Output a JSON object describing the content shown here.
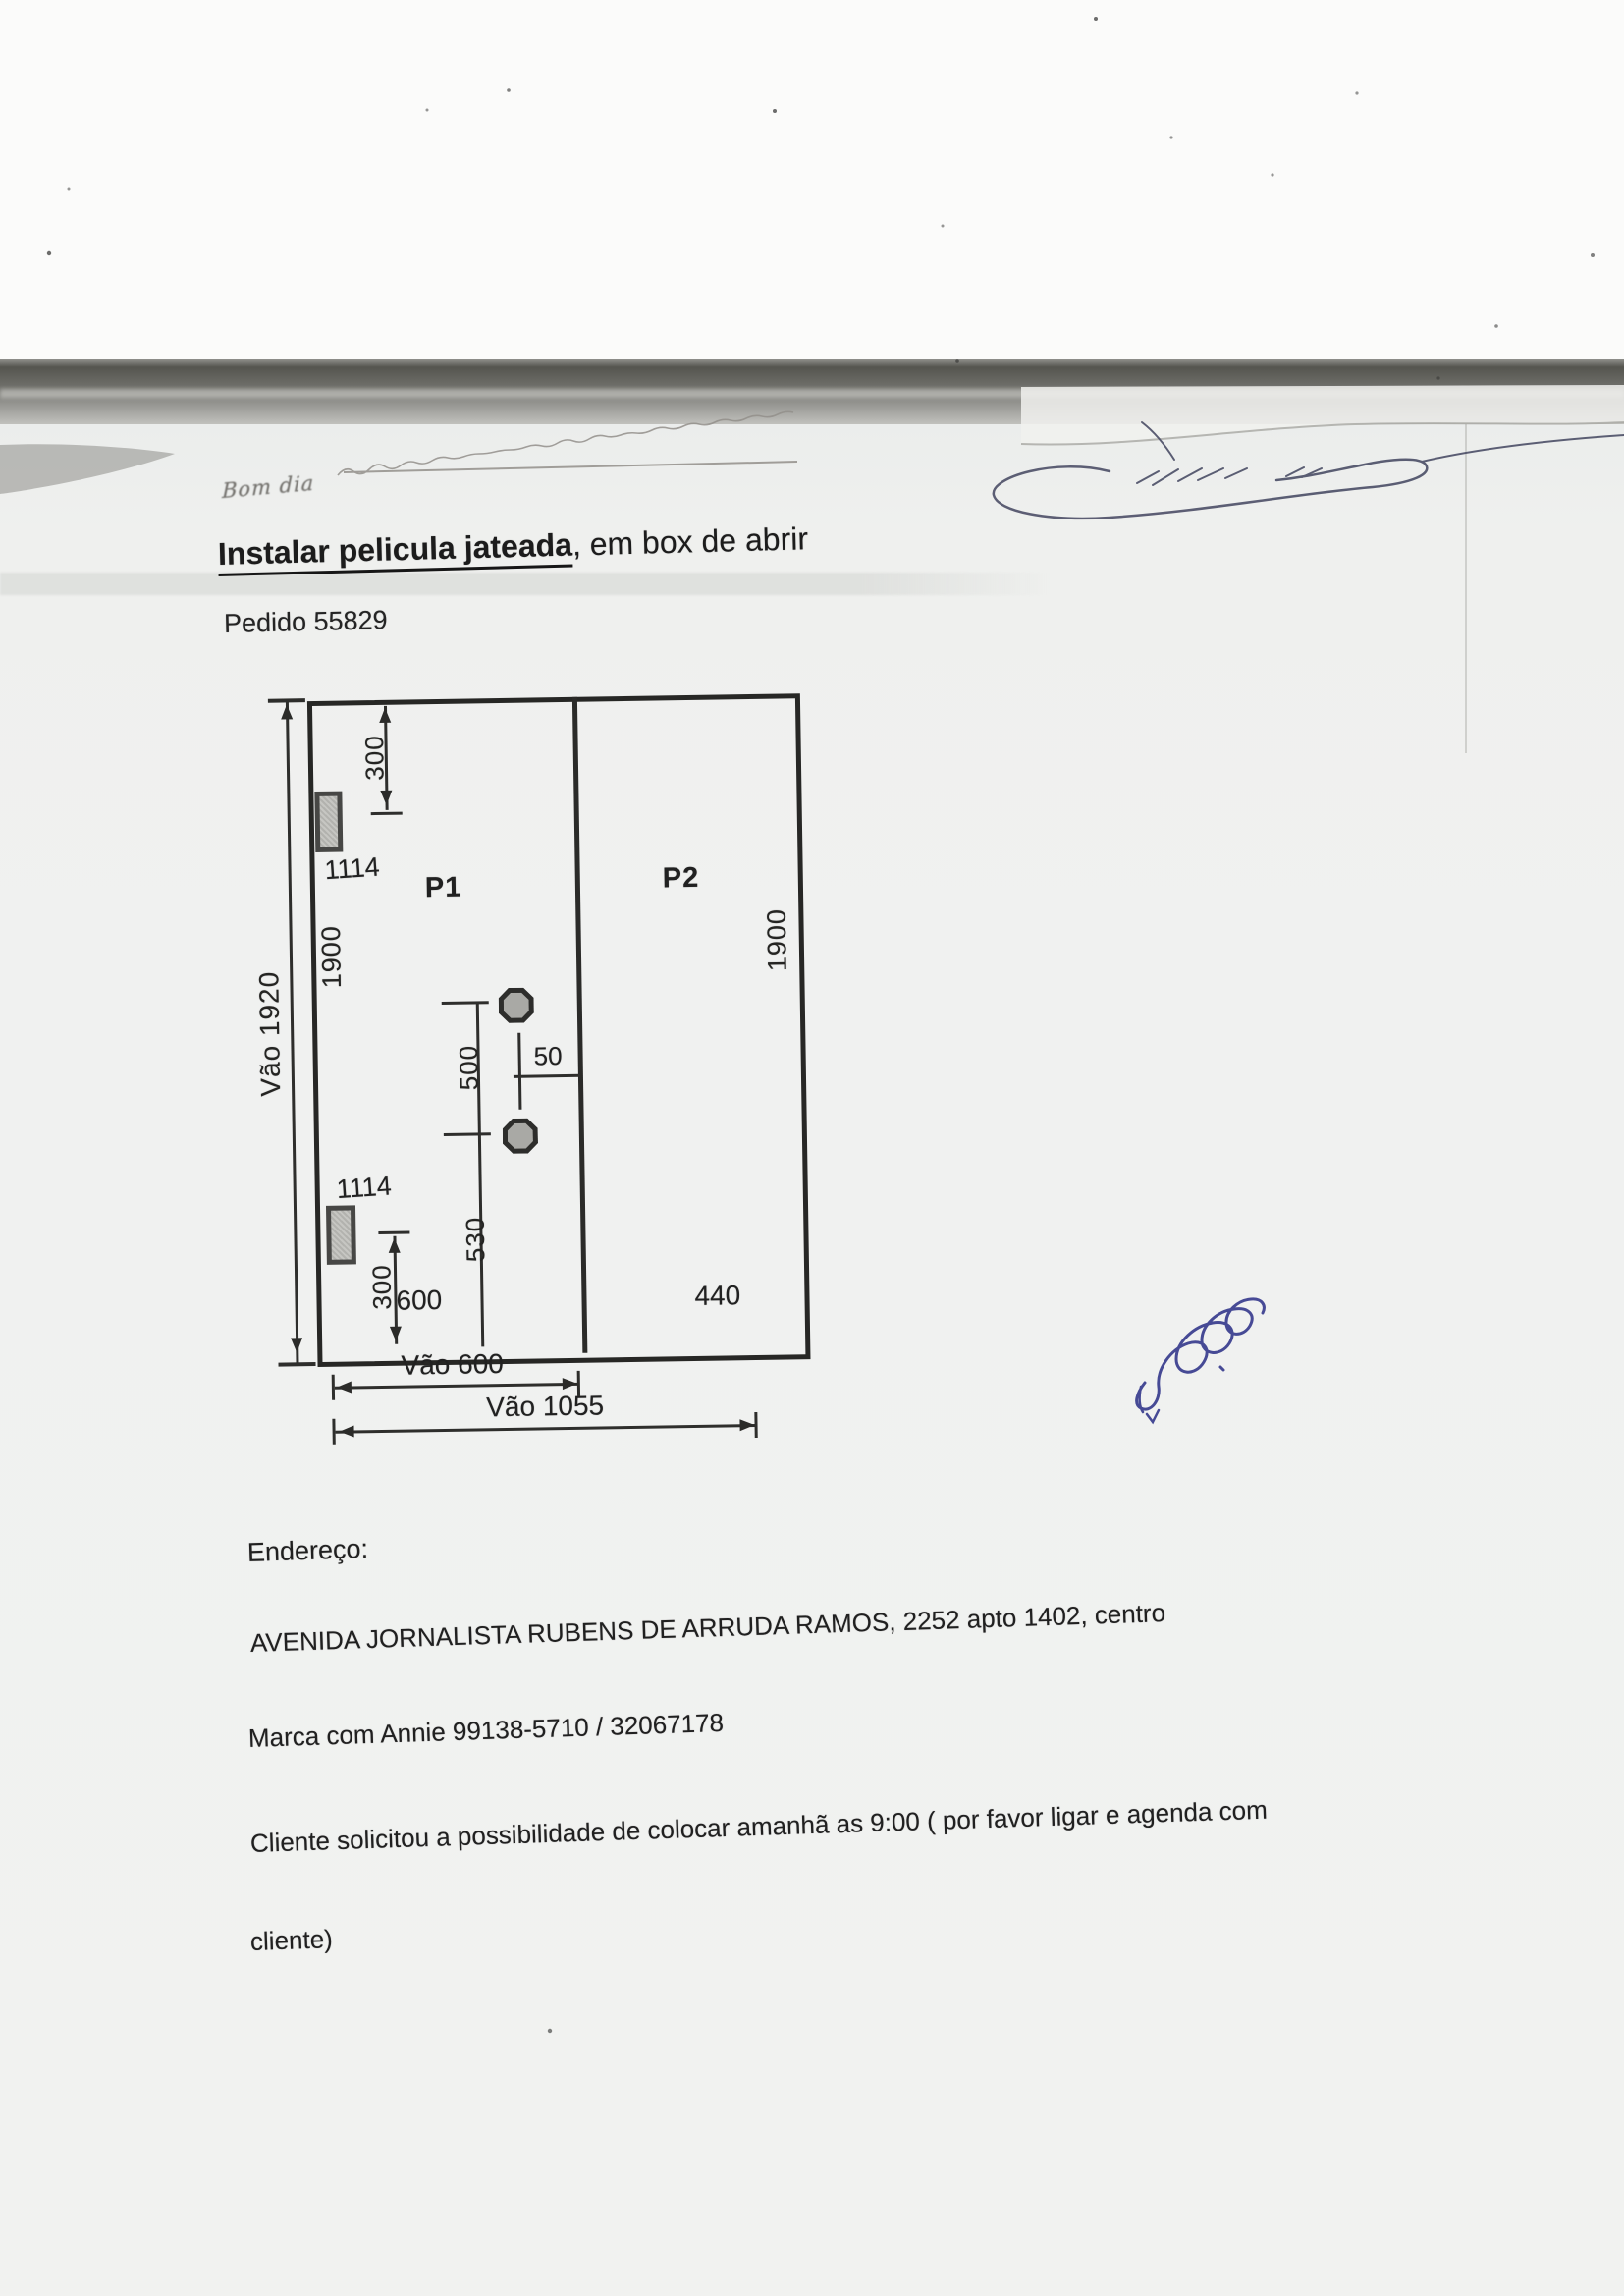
{
  "page": {
    "greeting": "Bom dia",
    "title_emphasis": "Instalar pelicula jateada",
    "title_rest": ", em box de abrir",
    "order": "Pedido 55829"
  },
  "diagram": {
    "overall_height": "Vão 1920",
    "panel1_height": "1900",
    "panel2_height": "1900",
    "hinge_top_offset": "300",
    "hinge_bottom_offset": "300",
    "hinge_model_top": "1114",
    "hinge_model_bottom": "1114",
    "panel1": "P1",
    "panel2": "P2",
    "knob_spacing": "500",
    "knob_edge_offset": "50",
    "knob_bottom_height": "530",
    "panel1_width": "600",
    "panel2_width": "440",
    "opening_width_panel1": "Vão 600",
    "opening_width_total": "Vão 1055"
  },
  "footer": {
    "address_label": "Endereço:",
    "address": "AVENIDA JORNALISTA RUBENS DE ARRUDA RAMOS, 2252 apto 1402, centro",
    "contact": "Marca com Annie 99138-5710 / 32067178",
    "note_line1": "Cliente solicitou a possibilidade de colocar amanhã as 9:00 ( por favor ligar e agenda com",
    "note_line2": "cliente)"
  },
  "colors": {
    "ink": "#1c1c1c",
    "signature_ink": "#4b4e66",
    "pen_blue": "#383c8e",
    "paper": "#eff0ee"
  }
}
